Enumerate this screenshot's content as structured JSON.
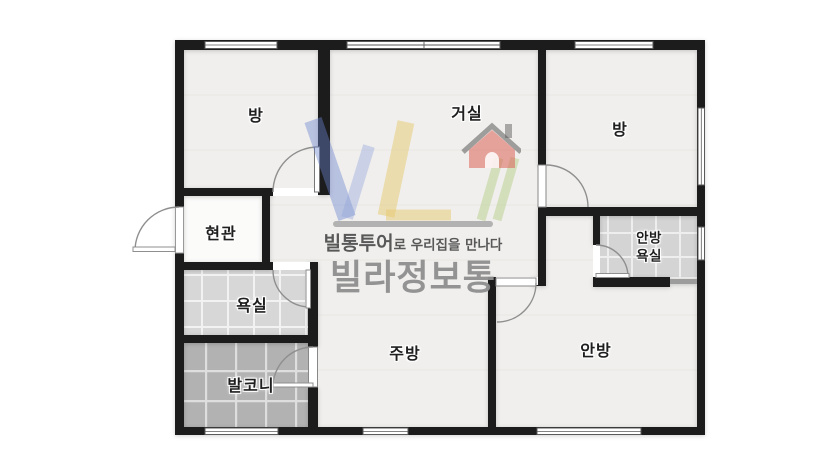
{
  "floorplan": {
    "rooms": {
      "room_top_left": {
        "label": "방"
      },
      "living_room": {
        "label": "거실"
      },
      "room_top_right": {
        "label": "방"
      },
      "entrance": {
        "label": "현관"
      },
      "bathroom": {
        "label": "욕실"
      },
      "balcony": {
        "label": "발코니"
      },
      "kitchen": {
        "label": "주방"
      },
      "master_bedroom": {
        "label": "안방"
      },
      "master_bathroom": {
        "line1": "안방",
        "line2": "욕실"
      }
    },
    "palette": {
      "wall": "#1c1c1c",
      "floor": "#f0efed",
      "bathroom_tile": "#d7d7d7",
      "balcony_tile": "#b2b2b2",
      "background": "#ffffff"
    }
  },
  "watermark": {
    "logo": "vl-house-logo",
    "tagline_brand": "빌통투어",
    "tagline_rest": "로 우리집을 만나다",
    "brand_title": "빌라정보통",
    "logo_colors": {
      "blue": "#6b82cf",
      "light_blue": "#93a6dc",
      "yellow": "#e6c96b",
      "green": "#b8cf8b",
      "red": "#dd6257",
      "title_gray": "#8f8f8f"
    }
  }
}
